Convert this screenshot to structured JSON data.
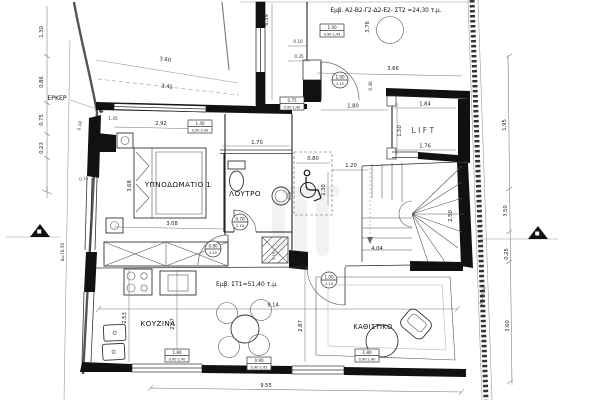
{
  "drawing": {
    "areas": {
      "upper": "Εμβ. Α2-Β2-Γ2-Δ2-Ε2- ΣΤ2 =24,30 τ.μ.",
      "main": "Εμβ. ΣΤ1=51,40 τ.μ."
    },
    "rooms": {
      "bedroom": "ΥΠΝΟΔΩΜΑΤΙΟ 1",
      "bathroom": "ΛΟΥΤΡΟ",
      "kitchen": "ΚΟΥΖΙΝΑ",
      "living": "ΚΑΘΙΣΤΙΚΟ",
      "lift": "LIFT",
      "erker": "ΕΡΚΕΡ"
    },
    "levels": {
      "left": "Δ=78.50",
      "right": "Δ=48.90"
    },
    "dims": {
      "left_1": "1.30",
      "left_2": "0.86",
      "left_3": "0.75",
      "left_4": "0.23",
      "wall_018": "0.18",
      "wall_015": "0.15",
      "top_360": "3.60",
      "top_345": "3.45",
      "bed_145": "1.45",
      "bed_292": "2.92",
      "bed_308": "3.08",
      "bed_368": "3.68",
      "bath_170": "1.70",
      "wc_080": "0.80",
      "wc_120": "1.20",
      "wc_130": "1.30",
      "up_639": "6.39",
      "up_376": "3.76",
      "up_366": "3.66",
      "up_030": "0.30",
      "up_010": "0.10",
      "up_035": "0.35",
      "hall_180": "1.80",
      "lift_184": "1.84",
      "lift_176": "1.76",
      "lift_150": "1.50",
      "stair_404": "4.04",
      "stair_250": "2.50",
      "kit_253": "2.53",
      "kit_267": "2.67",
      "liv_287": "2.87",
      "liv_914": "9.14",
      "right_195": "1.95",
      "right_350": "3.50",
      "right_025": "0.25",
      "right_360": "3.60",
      "bottom_955": "9.55",
      "shaft_070": "0.70"
    },
    "tags": {
      "win_bed": {
        "w": "1.40",
        "h": "0,90 2,40"
      },
      "win_up": {
        "w": "0.75",
        "h": "0,90 2,40"
      },
      "win_up2": {
        "w": "1.00",
        "h": "0,90 2,45"
      },
      "win_kit": {
        "w": "1.80",
        "h": "0,90 2,40"
      },
      "win_din": {
        "w": "0.90",
        "h": "0,90 2,45"
      },
      "win_liv": {
        "w": "1.80",
        "h": "0,90 2,40"
      },
      "door_bath": {
        "w": "0.70",
        "h": "2.10"
      },
      "door_bed": {
        "w": "0.80",
        "h": "2.10"
      },
      "door_up": {
        "w": "1.00",
        "h": "2.15"
      },
      "door_liv": {
        "w": "1.00",
        "h": "2.15"
      }
    }
  }
}
